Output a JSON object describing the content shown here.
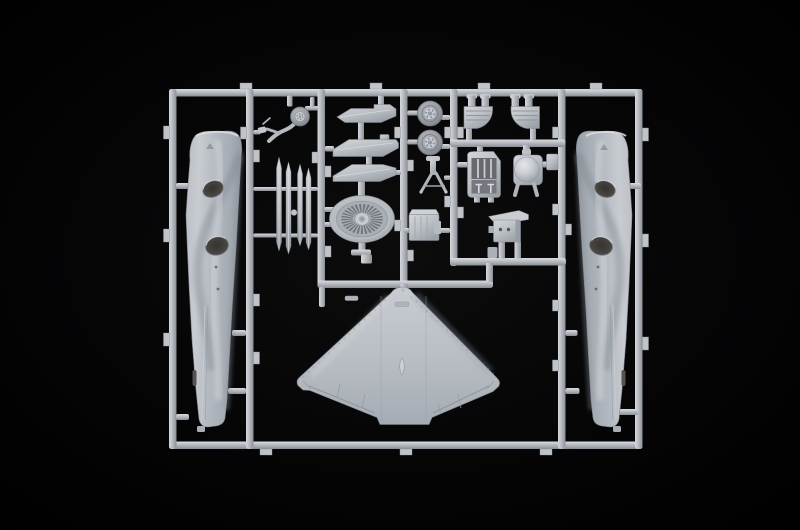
{
  "meta": {
    "type": "photograph",
    "alt": "Photograph of a light-gray injection-molded plastic model kit sprue (runner frame) for a jet aircraft kit, shot on a pure black background. The rectangular frame holds two vertical fuselage halves with dark oval intake openings, a one-piece swept delta wing at bottom center, an elliptical turbofan fan face, paired slender blade parts, three swept strake parts, two main wheels, a nose gear leg with wheel, intake duct halves, an instrument console, a domed tank, an equipment box and a small sensor pod, all attached to runners by small gates."
  },
  "colors": {
    "background": "#000000",
    "plastic-base": "#b8bdc3",
    "plastic-highlight": "#dcdfe3",
    "plastic-shadow": "#878d94",
    "opening-dark": "#46433f",
    "tire-gray": "#9ba1a7"
  },
  "sprue": {
    "material": "light gray polystyrene",
    "frame_shape": "rectangular runner frame with five inner vertical rails and three inner horizontal rails",
    "parts": [
      {
        "id": "left-fuselage-half",
        "label": "Fuselage half (left)",
        "count": 1
      },
      {
        "id": "right-fuselage-half",
        "label": "Fuselage half (right)",
        "count": 1
      },
      {
        "id": "lower-wing",
        "label": "One-piece swept delta wing",
        "count": 1
      },
      {
        "id": "engine-fan-disc",
        "label": "Turbofan engine fan face",
        "count": 1
      },
      {
        "id": "nose-gear-with-wheel",
        "label": "Nose landing gear leg with wheel",
        "count": 1
      },
      {
        "id": "blade-parts",
        "label": "Slender blade parts",
        "count": 4
      },
      {
        "id": "strake-parts",
        "label": "Swept strake parts",
        "count": 3
      },
      {
        "id": "main-wheels",
        "label": "Main wheels",
        "count": 2
      },
      {
        "id": "gear-strut-tripod",
        "label": "Gear retraction strut",
        "count": 1
      },
      {
        "id": "equipment-box",
        "label": "Equipment box",
        "count": 1
      },
      {
        "id": "intake-duct-halves",
        "label": "Intake duct halves",
        "count": 2
      },
      {
        "id": "instrument-console",
        "label": "Cockpit instrument console",
        "count": 1
      },
      {
        "id": "dome-tank",
        "label": "Domed tank part",
        "count": 1
      },
      {
        "id": "sensor-pod",
        "label": "Sensor pod part",
        "count": 1
      }
    ]
  }
}
